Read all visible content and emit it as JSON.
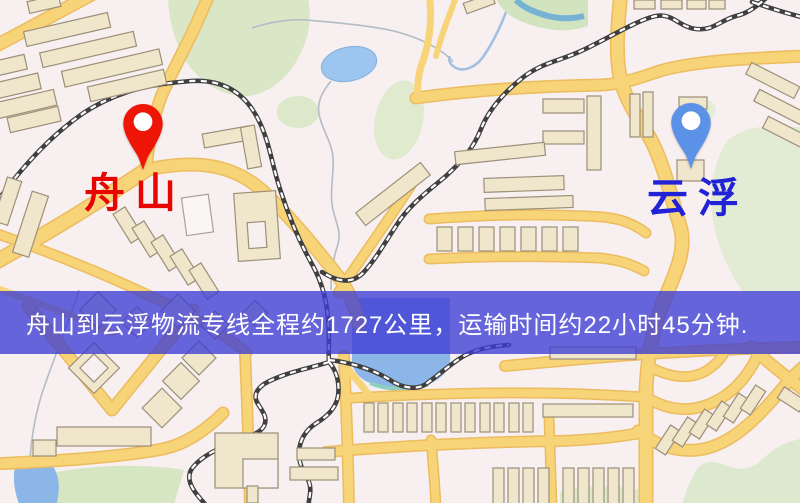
{
  "banner": {
    "text": "舟山到云浮物流专线全程约1727公里，运输时间约22小时45分钟.",
    "background_color": "#3e3cd4",
    "text_color": "#ffffff"
  },
  "route": {
    "origin": "舟山",
    "destination": "云浮",
    "distance_km": "1727",
    "duration": "22小时45分钟"
  },
  "markers": {
    "origin": {
      "label": "舟山",
      "pin_color": "#ee1506",
      "label_color": "#e60500"
    },
    "destination": {
      "label": "云浮",
      "pin_color": "#5b92e8",
      "label_color": "#2121d6"
    }
  },
  "map_colors": {
    "background": "#f7eff0",
    "road_fill": "#f7d478",
    "road_edge": "#ecbc5e",
    "railway": "#3f3f3f",
    "park_green": "#d9e7c6",
    "water_blue": "#8cb6e8",
    "building_fill": "#efe6cb",
    "building_stroke": "#9c9078"
  }
}
